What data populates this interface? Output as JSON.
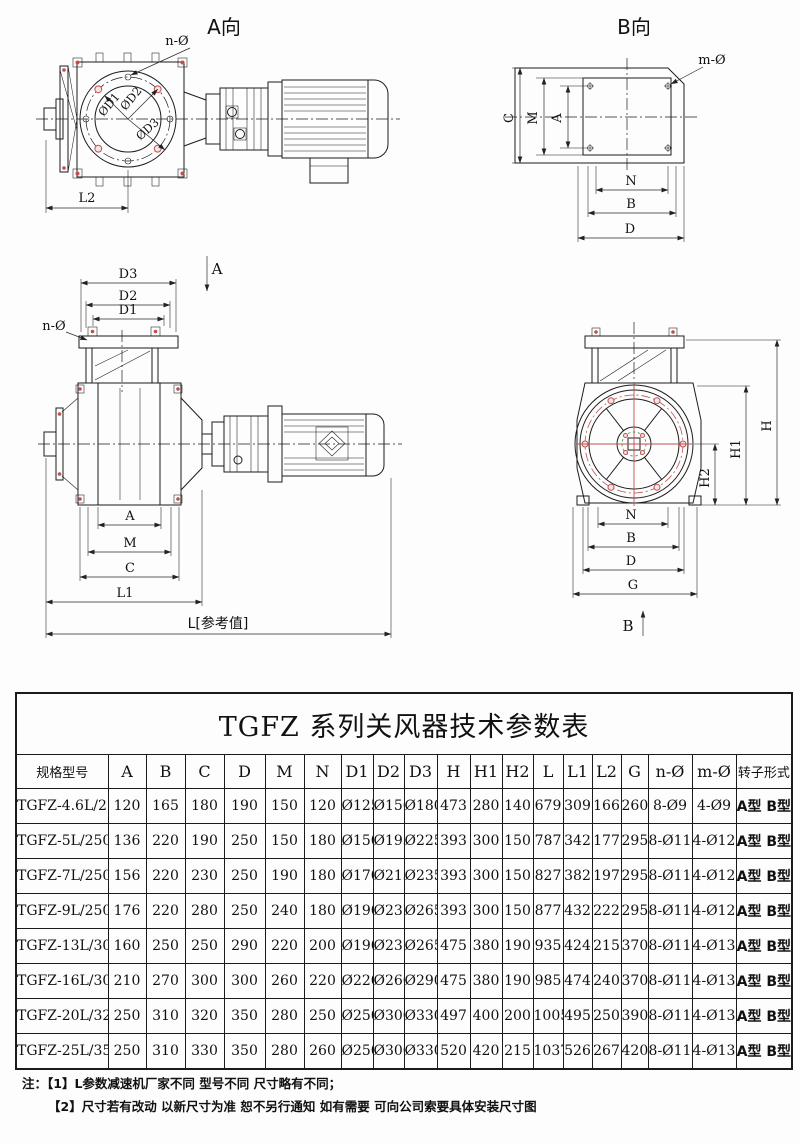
{
  "colors": {
    "line": "#1c1c1c",
    "dim": "#2a2a2a",
    "accent-red": "#c05050",
    "accent-green": "#4aa04a",
    "table-border": "#1a1a1a",
    "text": "#111111"
  },
  "drawings": {
    "view_a": {
      "title": "A向",
      "n_hole_label": "n-Ø",
      "dia1": "ØD1",
      "dia2": "ØD2",
      "dia3": "ØD3",
      "l2": "L2"
    },
    "view_b": {
      "title": "B向",
      "m_hole_label": "m-Ø",
      "dim_c": "C",
      "dim_m": "M",
      "dim_a": "A",
      "dim_n": "N",
      "dim_b": "B",
      "dim_d": "D"
    },
    "side_view": {
      "dim_d3": "D3",
      "dim_d2": "D2",
      "dim_d1": "D1",
      "n_hole_label": "n-Ø",
      "section_a": "A",
      "dim_a": "A",
      "dim_m": "M",
      "dim_c": "C",
      "dim_l1": "L1",
      "dim_l_ref": "L[参考值]"
    },
    "end_view": {
      "dim_h": "H",
      "dim_h1": "H1",
      "dim_h2": "H2",
      "dim_n": "N",
      "dim_b": "B",
      "dim_d": "D",
      "dim_g": "G",
      "section_b": "B"
    }
  },
  "table": {
    "title": "TGFZ 系列关风器技术参数表",
    "columns": [
      "规格型号",
      "A",
      "B",
      "C",
      "D",
      "M",
      "N",
      "D1",
      "D2",
      "D3",
      "H",
      "H1",
      "H2",
      "L",
      "L1",
      "L2",
      "G",
      "n-Ø",
      "m-Ø",
      "转子形式"
    ],
    "rows": [
      [
        "TGFZ-4.6L/210",
        "120",
        "165",
        "180",
        "190",
        "150",
        "120",
        "Ø125",
        "Ø156",
        "Ø180",
        "473",
        "280",
        "140",
        "679",
        "309",
        "166",
        "260",
        "8-Ø9",
        "4-Ø9",
        "A型 B型"
      ],
      [
        "TGFZ-5L/250",
        "136",
        "220",
        "190",
        "250",
        "150",
        "180",
        "Ø150",
        "Ø193",
        "Ø225",
        "393",
        "300",
        "150",
        "787",
        "342",
        "177",
        "295",
        "8-Ø11",
        "4-Ø12",
        "A型 B型"
      ],
      [
        "TGFZ-7L/250",
        "156",
        "220",
        "230",
        "250",
        "190",
        "180",
        "Ø170",
        "Ø213",
        "Ø235",
        "393",
        "300",
        "150",
        "827",
        "382",
        "197",
        "295",
        "8-Ø11",
        "4-Ø12",
        "A型 B型"
      ],
      [
        "TGFZ-9L/250",
        "176",
        "220",
        "280",
        "250",
        "240",
        "180",
        "Ø190",
        "Ø237",
        "Ø265",
        "393",
        "300",
        "150",
        "877",
        "432",
        "222",
        "295",
        "8-Ø11",
        "4-Ø12",
        "A型 B型"
      ],
      [
        "TGFZ-13L/300",
        "160",
        "250",
        "250",
        "290",
        "220",
        "200",
        "Ø190",
        "Ø237",
        "Ø265",
        "475",
        "380",
        "190",
        "935",
        "424",
        "215",
        "370",
        "8-Ø11",
        "4-Ø13",
        "A型 B型"
      ],
      [
        "TGFZ-16L/300",
        "210",
        "270",
        "300",
        "300",
        "260",
        "220",
        "Ø220",
        "Ø260",
        "Ø290",
        "475",
        "380",
        "190",
        "985",
        "474",
        "240",
        "370",
        "8-Ø11",
        "4-Ø13",
        "A型 B型"
      ],
      [
        "TGFZ-20L/320",
        "250",
        "310",
        "320",
        "350",
        "280",
        "250",
        "Ø250",
        "Ø300",
        "Ø330",
        "497",
        "400",
        "200",
        "1005",
        "495",
        "250",
        "390",
        "8-Ø11",
        "4-Ø13",
        "A型 B型"
      ],
      [
        "TGFZ-25L/350",
        "250",
        "310",
        "330",
        "350",
        "280",
        "260",
        "Ø250",
        "Ø300",
        "Ø330",
        "520",
        "420",
        "215",
        "1037",
        "526",
        "267",
        "420",
        "8-Ø11",
        "4-Ø13",
        "A型 B型"
      ]
    ]
  },
  "notes": {
    "line1": "注：【1】L参数减速机厂家不同 型号不同 尺寸略有不同；",
    "line2": "【2】尺寸若有改动 以新尺寸为准 恕不另行通知 如有需要 可向公司索要具体安装尺寸图"
  }
}
